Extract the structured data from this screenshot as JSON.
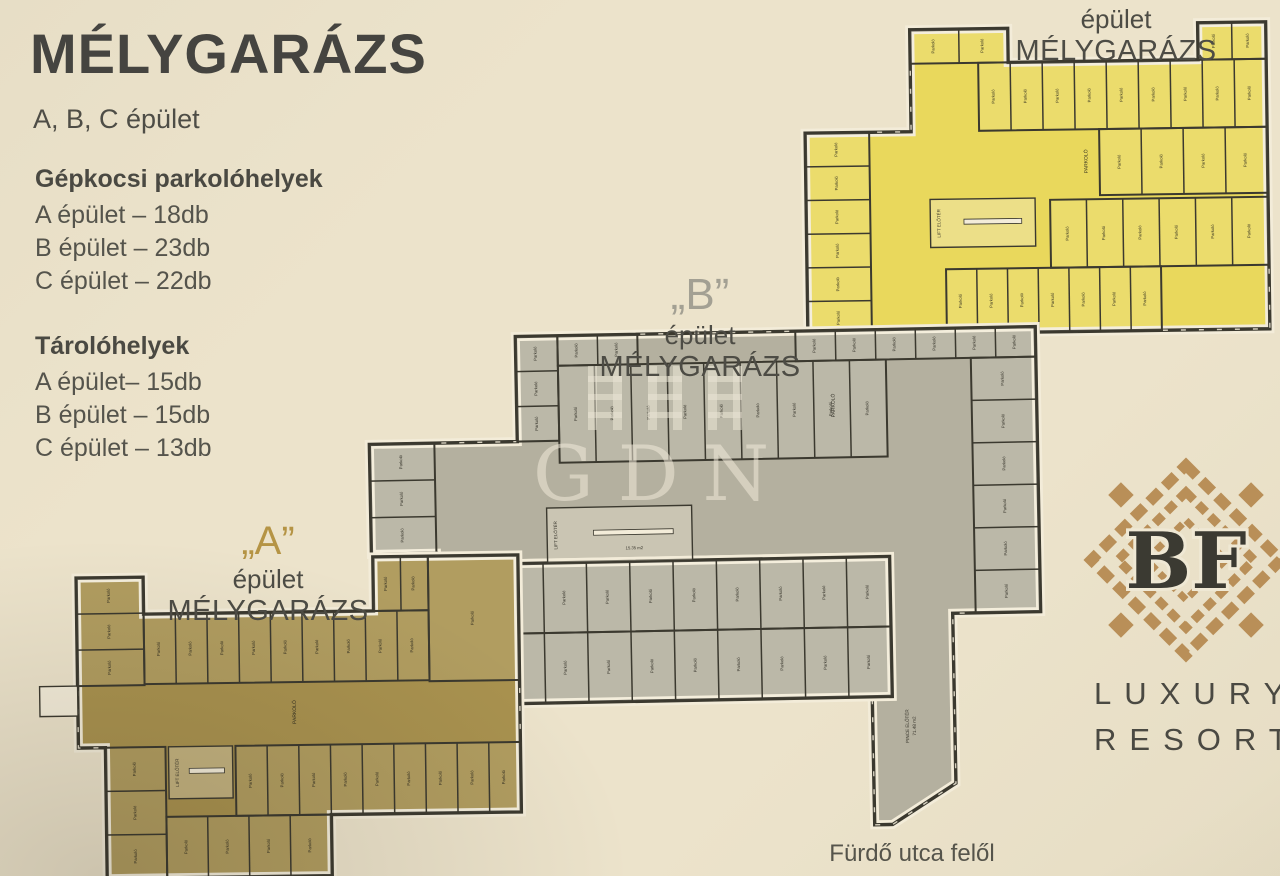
{
  "poster": {
    "title": "MÉLYGARÁZS",
    "subtitle": "A, B, C épület",
    "parking": {
      "heading": "Gépkocsi parkolóhelyek",
      "items": [
        "A épület – 18db",
        "B épület – 23db",
        "C épület – 22db"
      ]
    },
    "storage": {
      "heading": "Tárolóhelyek",
      "items": [
        "A épület– 15db",
        "B épület – 15db",
        "C épület – 13db"
      ]
    },
    "street_label": "Fürdő utca felől",
    "watermark": "GDN"
  },
  "building_labels": {
    "a": {
      "quote": "„A”",
      "line1": "épület",
      "line2": "MÉLYGARÁZS",
      "color": "#b59445"
    },
    "b": {
      "quote": "„B”",
      "line1": "épület",
      "line2": "MÉLYGARÁZS",
      "color": "#a3a093"
    },
    "c": {
      "quote": "„C”",
      "line1": "épület",
      "line2": "MÉLYGARÁZS",
      "color": "#cdb44e"
    }
  },
  "logo": {
    "monogram": "BF",
    "line1": "LUXURY",
    "line2": "RESORT",
    "pattern_color": "#b98f58",
    "text_color": "#3b3a32"
  },
  "floorplan": {
    "wall_color": "#3b392f",
    "paper_color": "#f3ecd9",
    "stall_label": "Parkoló",
    "lift_label": "LIFT ELŐTÉR",
    "buildings": [
      {
        "id": "building-c-plan",
        "fill": "#e9d85c",
        "tilt": -0.8,
        "cx": 1037,
        "cy": 195,
        "polys": [
          [
            [
              806,
              130
            ],
            [
              912,
              130
            ],
            [
              912,
              28
            ],
            [
              1010,
              28
            ],
            [
              1010,
              62
            ],
            [
              1200,
              62
            ],
            [
              1200,
              25
            ],
            [
              1268,
              25
            ],
            [
              1268,
              332
            ],
            [
              806,
              332
            ]
          ]
        ],
        "rows": [
          {
            "x": 806,
            "y": 130,
            "w": 64,
            "h": 202,
            "n": 6,
            "dir": "h"
          },
          {
            "x": 912,
            "y": 28,
            "w": 98,
            "h": 34,
            "n": 2,
            "dir": "v"
          },
          {
            "x": 980,
            "y": 62,
            "w": 288,
            "h": 68,
            "n": 9,
            "dir": "v"
          },
          {
            "x": 1200,
            "y": 25,
            "w": 68,
            "h": 37,
            "n": 2,
            "dir": "v"
          },
          {
            "x": 1100,
            "y": 130,
            "w": 168,
            "h": 66,
            "n": 4,
            "dir": "v"
          },
          {
            "x": 1050,
            "y": 200,
            "w": 218,
            "h": 68,
            "n": 6,
            "dir": "v"
          },
          {
            "x": 945,
            "y": 268,
            "w": 215,
            "h": 64,
            "n": 7,
            "dir": "v"
          }
        ],
        "core": {
          "x": 930,
          "y": 198,
          "w": 105,
          "h": 48,
          "area": ""
        },
        "notes": [
          {
            "x": 1088,
            "y": 162,
            "rot": -90,
            "size": 5,
            "lines": [
              "PARKOLÓ"
            ]
          }
        ]
      },
      {
        "id": "building-b-plan",
        "fill": "#b4b09f",
        "tilt": -1.1,
        "cx": 705,
        "cy": 580,
        "polys": [
          [
            [
              372,
              438
            ],
            [
              520,
              438
            ],
            [
              520,
              333
            ],
            [
              1040,
              333
            ],
            [
              1040,
              618
            ],
            [
              952,
              618
            ],
            [
              952,
              788
            ],
            [
              888,
              828
            ],
            [
              870,
              828
            ],
            [
              870,
              560
            ],
            [
              437,
              560
            ],
            [
              437,
              548
            ],
            [
              372,
              548
            ]
          ],
          [
            [
              430,
              560
            ],
            [
              890,
              560
            ],
            [
              890,
              700
            ],
            [
              430,
              700
            ]
          ]
        ],
        "rows": [
          {
            "x": 372,
            "y": 438,
            "w": 65,
            "h": 110,
            "n": 3,
            "dir": "h"
          },
          {
            "x": 520,
            "y": 333,
            "w": 42,
            "h": 105,
            "n": 3,
            "dir": "h"
          },
          {
            "x": 562,
            "y": 333,
            "w": 80,
            "h": 30,
            "n": 2,
            "dir": "v"
          },
          {
            "x": 562,
            "y": 363,
            "w": 328,
            "h": 97,
            "n": 9,
            "dir": "v"
          },
          {
            "x": 800,
            "y": 333,
            "w": 240,
            "h": 30,
            "n": 6,
            "dir": "v"
          },
          {
            "x": 975,
            "y": 363,
            "w": 65,
            "h": 255,
            "n": 6,
            "dir": "h"
          },
          {
            "x": 430,
            "y": 560,
            "w": 70,
            "h": 140,
            "n": 2,
            "dir": "h"
          },
          {
            "x": 500,
            "y": 560,
            "w": 390,
            "h": 70,
            "n": 9,
            "dir": "v"
          },
          {
            "x": 500,
            "y": 630,
            "w": 390,
            "h": 70,
            "n": 9,
            "dir": "v"
          }
        ],
        "core": {
          "x": 548,
          "y": 505,
          "w": 145,
          "h": 55,
          "area": "15.35 m2"
        },
        "notes": [
          {
            "x": 838,
            "y": 408,
            "rot": -90,
            "size": 5,
            "lines": [
              "PARKOLÓ"
            ]
          },
          {
            "x": 906,
            "y": 730,
            "rot": -90,
            "size": 4.6,
            "lines": [
              "PINCE ELŐTÉR",
              "71.48 m2"
            ]
          }
        ]
      },
      {
        "id": "building-a-plan",
        "fill": "#a9924f",
        "tilt": -0.8,
        "cx": 300,
        "cy": 715,
        "polys": [
          [
            [
              78,
              575
            ],
            [
              145,
              575
            ],
            [
              145,
              612
            ],
            [
              375,
              612
            ],
            [
              375,
              558
            ],
            [
              520,
              558
            ],
            [
              520,
              815
            ],
            [
              330,
              815
            ],
            [
              330,
              876
            ],
            [
              105,
              876
            ],
            [
              105,
              745
            ],
            [
              78,
              745
            ]
          ]
        ],
        "boxes": [
          {
            "x": 40,
            "y": 683,
            "w": 38,
            "h": 30
          }
        ],
        "rows": [
          {
            "x": 78,
            "y": 575,
            "w": 67,
            "h": 108,
            "n": 3,
            "dir": "h"
          },
          {
            "x": 145,
            "y": 612,
            "w": 285,
            "h": 70,
            "n": 9,
            "dir": "v"
          },
          {
            "x": 375,
            "y": 558,
            "w": 55,
            "h": 54,
            "n": 2,
            "dir": "v"
          },
          {
            "x": 430,
            "y": 558,
            "w": 90,
            "h": 125,
            "n": 1,
            "dir": "v"
          },
          {
            "x": 235,
            "y": 745,
            "w": 285,
            "h": 70,
            "n": 9,
            "dir": "v"
          },
          {
            "x": 105,
            "y": 745,
            "w": 60,
            "h": 131,
            "n": 3,
            "dir": "h"
          },
          {
            "x": 165,
            "y": 815,
            "w": 165,
            "h": 61,
            "n": 4,
            "dir": "v"
          }
        ],
        "core": {
          "x": 168,
          "y": 745,
          "w": 64,
          "h": 52,
          "area": ""
        },
        "notes": [
          {
            "x": 296,
            "y": 712,
            "rot": -90,
            "size": 5,
            "lines": [
              "PARKOLÓ"
            ]
          }
        ]
      }
    ]
  }
}
